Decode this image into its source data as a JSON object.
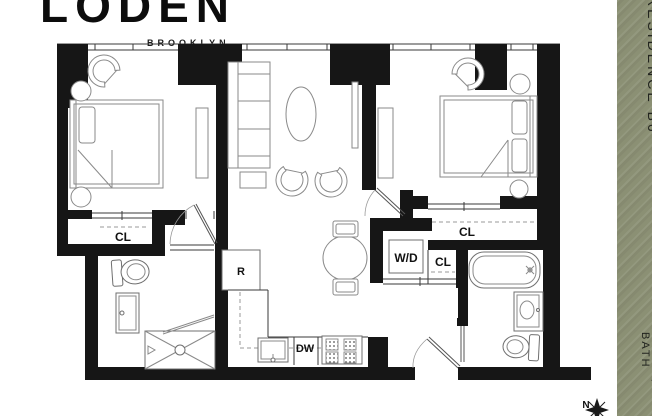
{
  "logo": {
    "brand": "LODEN",
    "city": "BROOKLYN"
  },
  "sidebar": {
    "residence": "RESIDENCE B6",
    "bedbath": "2 BED | 2 BATH",
    "color": "#8b9074"
  },
  "plan": {
    "labels": {
      "bedroom1_closet": "CL",
      "bedroom2_closet": "CL",
      "hall_closet": "CL",
      "washer_dryer": "W/D",
      "dishwasher": "DW",
      "refrigerator": "R"
    },
    "compass": "N"
  }
}
